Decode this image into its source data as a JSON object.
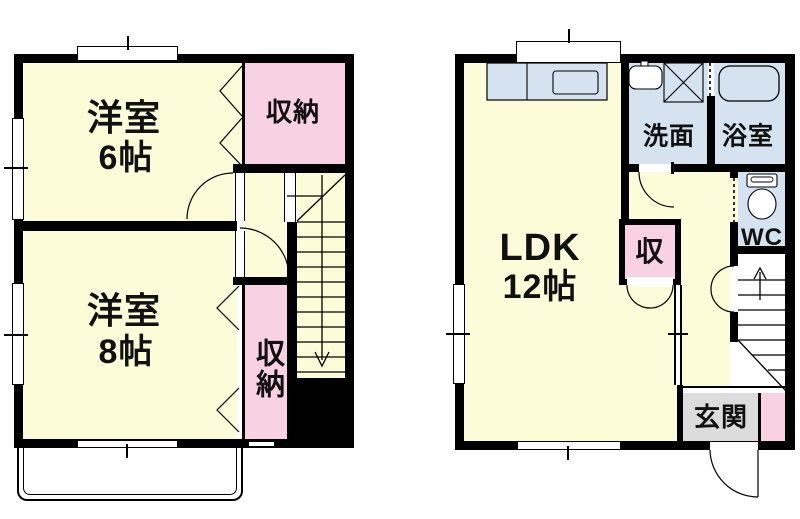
{
  "colors": {
    "room_yellow": "#FCFCD9",
    "closet_pink": "#F8D2E2",
    "wet_blue": "#D5E3F1",
    "entry_gray": "#DCDCDC",
    "wall_black": "#000000",
    "background": "#FFFFFF"
  },
  "left_plan": {
    "bedroom6": {
      "name": "洋室",
      "size": "6帖"
    },
    "closet_top": {
      "label": "収納"
    },
    "bedroom8": {
      "name": "洋室",
      "size": "8帖"
    },
    "closet_side": {
      "label": "収納"
    }
  },
  "right_plan": {
    "ldk": {
      "name": "LDK",
      "size": "12帖"
    },
    "washroom": {
      "label": "洗面"
    },
    "bathroom": {
      "label": "浴室"
    },
    "wc": {
      "label": "WC"
    },
    "storage": {
      "label": "収"
    },
    "entrance": {
      "label": "玄関"
    }
  }
}
